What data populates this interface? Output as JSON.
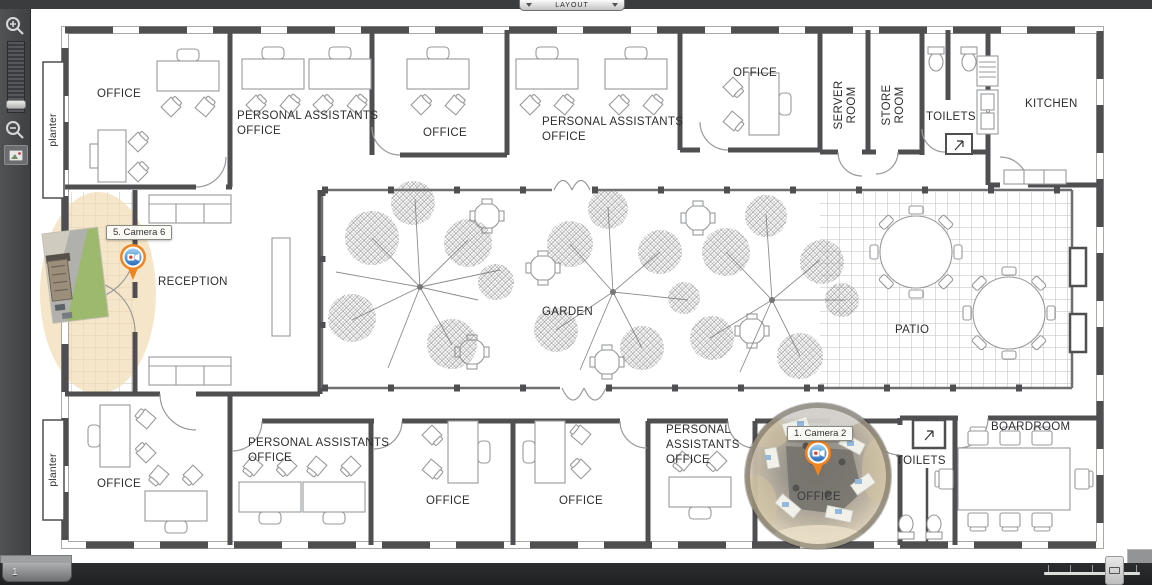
{
  "chrome": {
    "layout_tab": {
      "label": "LAYOUT"
    },
    "page_tab": {
      "label": "1"
    },
    "toolbar_icons": [
      "zoom-in-icon",
      "zoom-slider",
      "zoom-out-icon",
      "image-overlay-icon"
    ]
  },
  "colors": {
    "camera_pin_orange": "#F08421",
    "camera_pin_blue": "#3F83C9",
    "fov_beige": "#F2DDB4",
    "chrome_dark": "#3C3E40",
    "wall_gray": "#4F4F51"
  },
  "floorplan": {
    "rooms": [
      {
        "id": "office-top-1",
        "label": "OFFICE"
      },
      {
        "id": "pa-office-top-1",
        "label": "PERSONAL ASSISTANTS\nOFFICE"
      },
      {
        "id": "office-top-2",
        "label": "OFFICE"
      },
      {
        "id": "pa-office-top-2",
        "label": "PERSONAL ASSISTANTS\nOFFICE"
      },
      {
        "id": "office-top-3",
        "label": "OFFICE"
      },
      {
        "id": "server-room",
        "label": "SERVER\nROOM"
      },
      {
        "id": "store-room",
        "label": "STORE\nROOM"
      },
      {
        "id": "toilets-top",
        "label": "TOILETS"
      },
      {
        "id": "kitchen",
        "label": "KITCHEN"
      },
      {
        "id": "planter-top",
        "label": "planter"
      },
      {
        "id": "reception",
        "label": "RECEPTION"
      },
      {
        "id": "garden",
        "label": "GARDEN"
      },
      {
        "id": "patio",
        "label": "PATIO"
      },
      {
        "id": "planter-bottom",
        "label": "planter"
      },
      {
        "id": "office-bottom-1",
        "label": "OFFICE"
      },
      {
        "id": "pa-office-bottom-1",
        "label": "PERSONAL ASSISTANTS\nOFFICE"
      },
      {
        "id": "office-bottom-2",
        "label": "OFFICE"
      },
      {
        "id": "office-bottom-3",
        "label": "OFFICE"
      },
      {
        "id": "pa-office-bottom-2",
        "label": "PERSONAL\nASSISTANTS\nOFFICE"
      },
      {
        "id": "office-bottom-4",
        "label": "OFFICE"
      },
      {
        "id": "toilets-bottom",
        "label": "TOILETS"
      },
      {
        "id": "boardroom",
        "label": "BOARDROOM"
      }
    ],
    "cameras": [
      {
        "id": "camera-6",
        "label": "5. Camera 6"
      },
      {
        "id": "camera-2",
        "label": "1. Camera 2"
      }
    ]
  }
}
